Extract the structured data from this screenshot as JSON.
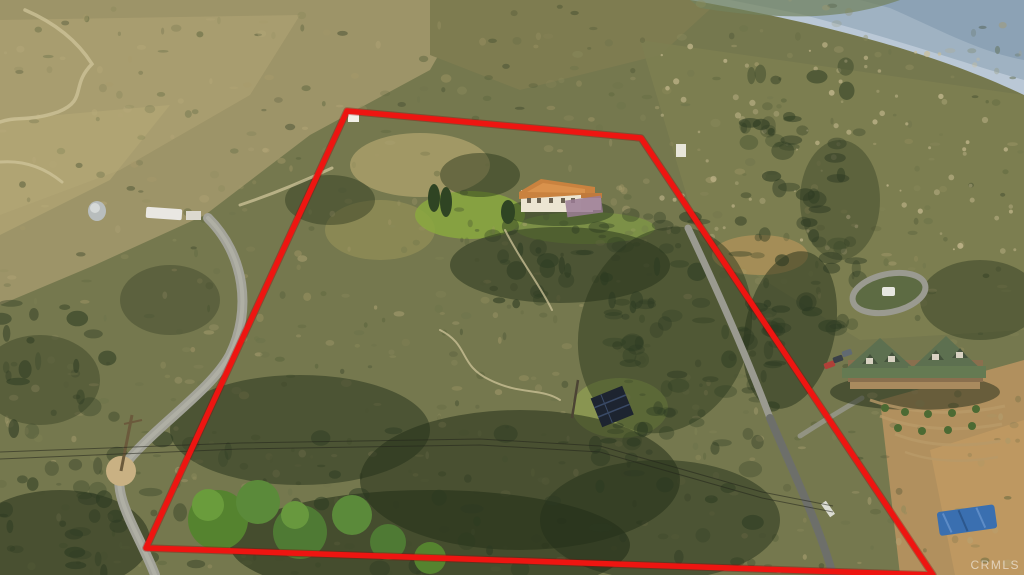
{
  "watermark": {
    "text": "CRMLS",
    "color": "#ffffff"
  },
  "boundary": {
    "points": "347,111 641,138 933,575 146,548",
    "color": "#ee1511"
  },
  "palette": {
    "hill_tan": "#a09668",
    "hill_olive": "#75784e",
    "mountain_haze": "#9fb2c2",
    "mountain_far": "#bac8d6",
    "shadow_green": "#243019",
    "bright_tree": "#5b8a3a",
    "road_gray": "#a3a399",
    "paved_gray": "#71736c",
    "roof_terracotta": "#c9823f",
    "lodge_roof_green": "#5d7050",
    "tarp_blue": "#3a6fb0",
    "speckles": [
      "#3f4a2e",
      "#55603a",
      "#6b724a",
      "#8b8a5c",
      "#a79a6a",
      "#b7a97a"
    ],
    "rock": "#cdbf95",
    "dark_bush": "#2c3a22"
  }
}
